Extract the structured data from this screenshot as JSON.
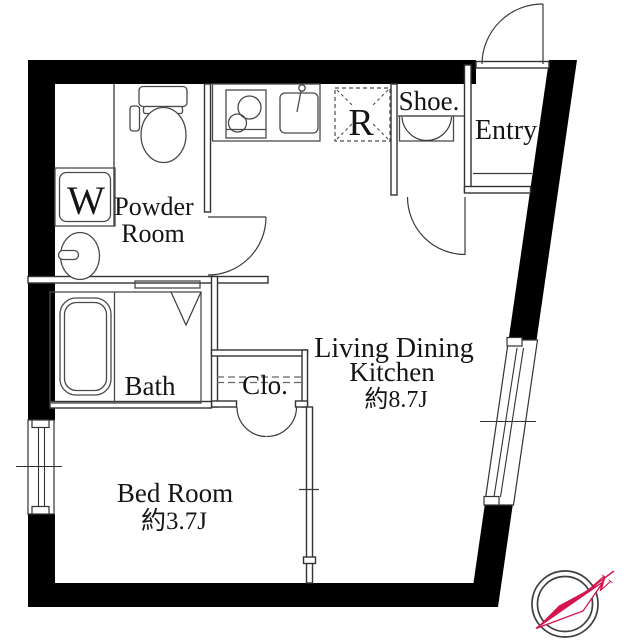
{
  "rooms": {
    "powder": {
      "line1": "Powder",
      "line2": "Room"
    },
    "bath": {
      "label": "Bath"
    },
    "closet": {
      "label": "Clo."
    },
    "bedroom": {
      "label": "Bed Room",
      "area": "約3.7J"
    },
    "ldk": {
      "line1": "Living Dining",
      "line2": "Kitchen",
      "area": "約8.7J"
    },
    "entry": {
      "label": "Entry"
    },
    "shoe": {
      "label": "Shoe."
    },
    "fridge": {
      "label": "R"
    },
    "washer": {
      "label": "W"
    }
  },
  "compass": {
    "north_label": "N"
  },
  "fixtures": [
    "toilet",
    "washing-machine",
    "washbasin",
    "bathtub",
    "stove",
    "kitchen-sink",
    "refrigerator-space",
    "shoe-cabinet",
    "compass"
  ],
  "colors": {
    "wall": "#000000",
    "line": "#3a3a3a",
    "accent": "#d5134e",
    "text": "#151515"
  }
}
